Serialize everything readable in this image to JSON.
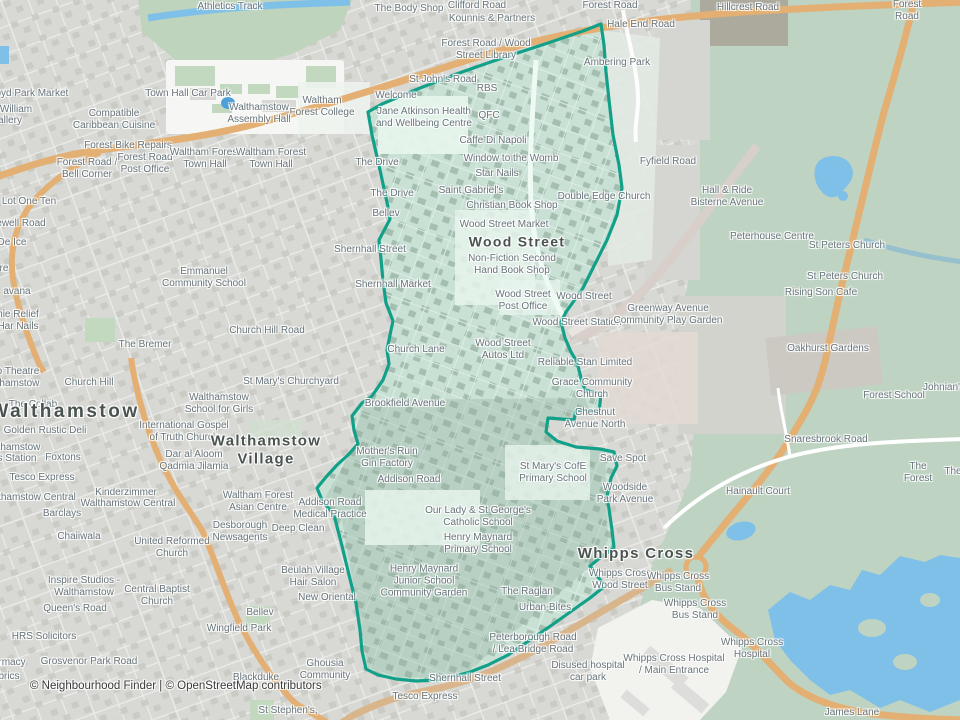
{
  "map": {
    "attribution": "© Neighbourhood Finder | © OpenStreetMap contributors",
    "colors": {
      "boundary": "#12a089",
      "boundary_fill": "#c9e0d5",
      "water": "#7fc0e8",
      "forest": "#bed3c2",
      "urban": "#d8d8d4",
      "road_primary": "#e3af72",
      "label_gray": "#67747a"
    },
    "labels": [
      {
        "t": "Athletics Track",
        "x": 230,
        "y": 7
      },
      {
        "t": "The Body Shop",
        "x": 409,
        "y": 9
      },
      {
        "t": "Clifford Road",
        "x": 477,
        "y": 6
      },
      {
        "t": "Kounnis & Partners",
        "x": 492,
        "y": 19
      },
      {
        "t": "Forest Road",
        "x": 610,
        "y": 6
      },
      {
        "t": "Hillcrest Road",
        "x": 748,
        "y": 8
      },
      {
        "t": "Forest Road",
        "x": 907,
        "y": 11
      },
      {
        "t": "Hale End Road",
        "x": 641,
        "y": 25
      },
      {
        "t": "Forest Road / Wood\nStreet Library",
        "x": 486,
        "y": 50
      },
      {
        "t": "Ambering Park",
        "x": 617,
        "y": 63
      },
      {
        "t": "St John's Road",
        "x": 443,
        "y": 80
      },
      {
        "t": "RBS",
        "x": 487,
        "y": 89
      },
      {
        "t": "Welcome",
        "x": 396,
        "y": 96
      },
      {
        "t": "Waltham\nForest College",
        "x": 322,
        "y": 107
      },
      {
        "t": "Town Hall Car Park",
        "x": 188,
        "y": 94
      },
      {
        "t": "Walthamstow\nAssembly Hall",
        "x": 259,
        "y": 114
      },
      {
        "t": "Lloyd Park Market",
        "x": 28,
        "y": 94
      },
      {
        "t": "William",
        "x": 16,
        "y": 110
      },
      {
        "t": "allery",
        "x": 10,
        "y": 121
      },
      {
        "t": "Compatible\nCaribbean Cuisine",
        "x": 114,
        "y": 120
      },
      {
        "t": "Forest Bike Repairs",
        "x": 128,
        "y": 146
      },
      {
        "t": "Forest Road /\nBell Corner",
        "x": 87,
        "y": 169
      },
      {
        "t": "Forest Road\nPost Office",
        "x": 145,
        "y": 164
      },
      {
        "t": "Waltham Forest\nTown Hall",
        "x": 205,
        "y": 159
      },
      {
        "t": "Waltham Forest\nTown Hall",
        "x": 271,
        "y": 159
      },
      {
        "t": "Lot One Ten",
        "x": 29,
        "y": 202
      },
      {
        "t": "ewell Road",
        "x": 21,
        "y": 224
      },
      {
        "t": "De Ice",
        "x": 12,
        "y": 243
      },
      {
        "t": "re",
        "x": 4,
        "y": 269
      },
      {
        "t": "avana",
        "x": 17,
        "y": 292
      },
      {
        "t": "nie Relief",
        "x": 18,
        "y": 315
      },
      {
        "t": "Har Nails",
        "x": 18,
        "y": 327
      },
      {
        "t": "o Theatre\nthamstow",
        "x": 18,
        "y": 378
      },
      {
        "t": "The Collab",
        "x": 33,
        "y": 405
      },
      {
        "t": "Emmanuel\nCommunity School",
        "x": 204,
        "y": 278
      },
      {
        "t": "Church Hill Road",
        "x": 267,
        "y": 331
      },
      {
        "t": "The Bremer",
        "x": 145,
        "y": 345
      },
      {
        "t": "Church Hill",
        "x": 89,
        "y": 383
      },
      {
        "t": "St Mary's Churchyard",
        "x": 291,
        "y": 382
      },
      {
        "t": "Walthamstow",
        "x": 65,
        "y": 412,
        "cls": "city"
      },
      {
        "t": "Golden Rustic Deli",
        "x": 45,
        "y": 431
      },
      {
        "t": "thamstow",
        "x": 19,
        "y": 448
      },
      {
        "t": "s Station",
        "x": 17,
        "y": 459
      },
      {
        "t": "Foxtons",
        "x": 63,
        "y": 458
      },
      {
        "t": "Tesco Express",
        "x": 42,
        "y": 478
      },
      {
        "t": "thamstow Central",
        "x": 37,
        "y": 498
      },
      {
        "t": "Kinderzimmer",
        "x": 126,
        "y": 493
      },
      {
        "t": "Walthamstow Central",
        "x": 128,
        "y": 504
      },
      {
        "t": "Barclays",
        "x": 62,
        "y": 514
      },
      {
        "t": "Walthamstow\nSchool for Girls",
        "x": 219,
        "y": 404
      },
      {
        "t": "International Gospel\nof Truth Church",
        "x": 184,
        "y": 432
      },
      {
        "t": "Dar al Aloom\nQadmia Jilamia",
        "x": 194,
        "y": 461
      },
      {
        "t": "Walthamstow\nVillage",
        "x": 266,
        "y": 450,
        "cls": "town"
      },
      {
        "t": "Waltham Forest\nAsian Centre",
        "x": 258,
        "y": 502
      },
      {
        "t": "Addison Road\nMedical Practice",
        "x": 330,
        "y": 509
      },
      {
        "t": "Desborough\nNewsagents",
        "x": 240,
        "y": 532
      },
      {
        "t": "Deep Clean",
        "x": 298,
        "y": 529
      },
      {
        "t": "Chaiiwala",
        "x": 79,
        "y": 537
      },
      {
        "t": "United Reformed\nChurch",
        "x": 172,
        "y": 548
      },
      {
        "t": "Inspire Studios -\nWalthamstow",
        "x": 84,
        "y": 587
      },
      {
        "t": "Central Baptist\nChurch",
        "x": 157,
        "y": 596
      },
      {
        "t": "Beulah Village\nHair Salon",
        "x": 313,
        "y": 577
      },
      {
        "t": "New Oriental",
        "x": 327,
        "y": 598
      },
      {
        "t": "Queen's Road",
        "x": 75,
        "y": 609
      },
      {
        "t": "Bellev",
        "x": 260,
        "y": 613
      },
      {
        "t": "Wingfield Park",
        "x": 239,
        "y": 629
      },
      {
        "t": "HRS Solicitors",
        "x": 44,
        "y": 637
      },
      {
        "t": "rmacy",
        "x": 12,
        "y": 663
      },
      {
        "t": "brics",
        "x": 9,
        "y": 677
      },
      {
        "t": "Grosvenor Park Road",
        "x": 89,
        "y": 662
      },
      {
        "t": "Blackduke",
        "x": 256,
        "y": 678
      },
      {
        "t": "Ghousia\nCommunity",
        "x": 325,
        "y": 670
      },
      {
        "t": "St Stephen's,",
        "x": 288,
        "y": 711
      },
      {
        "t": "Jane Atkinson Health\nand Wellbeing Centre",
        "x": 424,
        "y": 118
      },
      {
        "t": "QFC",
        "x": 489,
        "y": 116
      },
      {
        "t": "Caffe Di Napoli",
        "x": 493,
        "y": 141
      },
      {
        "t": "Window to the Womb",
        "x": 511,
        "y": 159
      },
      {
        "t": "Star Nails",
        "x": 497,
        "y": 174
      },
      {
        "t": "Saint Gabriel's",
        "x": 471,
        "y": 191
      },
      {
        "t": "Christian Book Shop",
        "x": 512,
        "y": 206
      },
      {
        "t": "The Drive",
        "x": 377,
        "y": 163
      },
      {
        "t": "The Drive",
        "x": 392,
        "y": 194
      },
      {
        "t": "Double Edge Church",
        "x": 604,
        "y": 197
      },
      {
        "t": "Bellev",
        "x": 386,
        "y": 214
      },
      {
        "t": "Shernhall Street",
        "x": 370,
        "y": 250
      },
      {
        "t": "Shernhall Market",
        "x": 393,
        "y": 285
      },
      {
        "t": "Wood Street Market",
        "x": 504,
        "y": 225
      },
      {
        "t": "Wood Street",
        "x": 517,
        "y": 242,
        "cls": "town",
        "fs": 14
      },
      {
        "t": "Non-Fiction Second\nHand Book Shop",
        "x": 512,
        "y": 265
      },
      {
        "t": "Wood Street\nPost Office",
        "x": 523,
        "y": 301
      },
      {
        "t": "Wood Street",
        "x": 584,
        "y": 297
      },
      {
        "t": "Wood Street Station",
        "x": 577,
        "y": 323
      },
      {
        "t": "Greenway Avenue\nCommunity Play Garden",
        "x": 668,
        "y": 315
      },
      {
        "t": "Church Lane",
        "x": 416,
        "y": 350
      },
      {
        "t": "Wood Street\nAutos Ltd",
        "x": 503,
        "y": 350
      },
      {
        "t": "Reliable Stan Limited",
        "x": 585,
        "y": 363
      },
      {
        "t": "Grace Community\nChurch",
        "x": 592,
        "y": 389
      },
      {
        "t": "Chestnut\nAvenue North",
        "x": 595,
        "y": 419
      },
      {
        "t": "Brookfield Avenue",
        "x": 405,
        "y": 404
      },
      {
        "t": "Mother's Ruin\nGin Factory",
        "x": 387,
        "y": 458
      },
      {
        "t": "Addison Road",
        "x": 409,
        "y": 480
      },
      {
        "t": "St Mary's CofE\nPrimary School",
        "x": 553,
        "y": 473
      },
      {
        "t": "Save Spot",
        "x": 623,
        "y": 459
      },
      {
        "t": "Woodside\nPark Avenue",
        "x": 625,
        "y": 494
      },
      {
        "t": "Our Lady & St George's\nCatholic School",
        "x": 478,
        "y": 517
      },
      {
        "t": "Henry Maynard\nPrimary School",
        "x": 478,
        "y": 544
      },
      {
        "t": "Henry Maynard\nJunior School\nCommunity Garden",
        "x": 424,
        "y": 581
      },
      {
        "t": "The Raglan",
        "x": 527,
        "y": 592
      },
      {
        "t": "Urban Bites",
        "x": 545,
        "y": 608
      },
      {
        "t": "Peterborough Road\n/ Lea Bridge Road",
        "x": 533,
        "y": 644
      },
      {
        "t": "Shernhall Street",
        "x": 465,
        "y": 679
      },
      {
        "t": "Tesco Express",
        "x": 425,
        "y": 697
      },
      {
        "t": "Disused hospital\ncar park",
        "x": 588,
        "y": 672
      },
      {
        "t": "Whipps Cross",
        "x": 636,
        "y": 554,
        "cls": "town"
      },
      {
        "t": "Whipps Cross\nWood Street",
        "x": 620,
        "y": 580
      },
      {
        "t": "Whipps Cross\nBus Stand",
        "x": 678,
        "y": 583
      },
      {
        "t": "Whipps Cross\nBus Stand",
        "x": 695,
        "y": 610
      },
      {
        "t": "Whipps Cross\nHospital",
        "x": 752,
        "y": 649
      },
      {
        "t": "Whipps Cross Hospital\n/ Main Entrance",
        "x": 674,
        "y": 665
      },
      {
        "t": "James Lane",
        "x": 852,
        "y": 713
      },
      {
        "t": "Fyfield Road",
        "x": 668,
        "y": 162
      },
      {
        "t": "Hall & Ride\nBisterne Avenue",
        "x": 727,
        "y": 197
      },
      {
        "t": "Peterhouse Centre",
        "x": 772,
        "y": 237
      },
      {
        "t": "St Peters Church",
        "x": 847,
        "y": 246
      },
      {
        "t": "St Peters Church",
        "x": 845,
        "y": 277
      },
      {
        "t": "Rising Son Cafe",
        "x": 821,
        "y": 293
      },
      {
        "t": "Oakhurst Gardens",
        "x": 828,
        "y": 349
      },
      {
        "t": "Forest School",
        "x": 894,
        "y": 396
      },
      {
        "t": "Johnian's",
        "x": 944,
        "y": 388
      },
      {
        "t": "Snaresbrook Road",
        "x": 826,
        "y": 440
      },
      {
        "t": "The Forest",
        "x": 918,
        "y": 473
      },
      {
        "t": "The",
        "x": 953,
        "y": 472
      },
      {
        "t": "Hainault Court",
        "x": 758,
        "y": 492
      }
    ]
  }
}
